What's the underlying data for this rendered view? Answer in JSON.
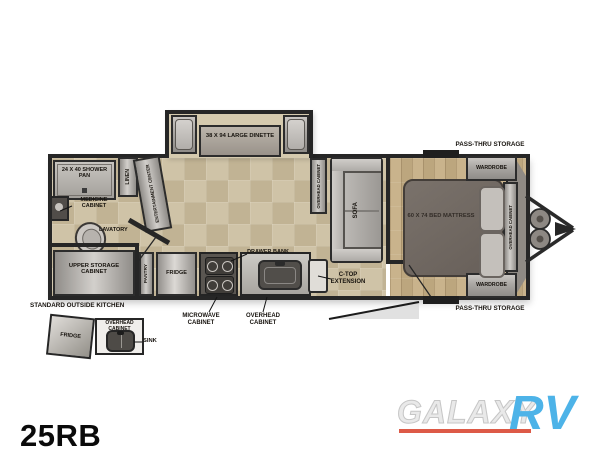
{
  "model": "25RB",
  "watermark": {
    "name": "GALAXY",
    "suffix": "RV"
  },
  "colors": {
    "wall": "#262626",
    "floor_main": "#cbbfa2",
    "floor_bedroom": "#c3ad86",
    "brand_blue": "#4db3e8",
    "brand_red": "#dd5a47"
  },
  "labels": {
    "shower": "24 x 40 SHOWER PAN",
    "linen": "LINEN",
    "medicine_cabinet": "MEDICINE CABINET",
    "lavatory": "LAVATORY",
    "entertainment_center": "ENTERTAINMENT CENTER",
    "upper_storage": "UPPER STORAGE CABINET",
    "pantry": "PANTRY",
    "fridge": "FRIDGE",
    "microwave_cabinet": "MICROWAVE CABINET",
    "overhead_cabinet": "OVERHEAD CABINET",
    "drawer_bank": "DRAWER BANK",
    "ctop_extension": "C-TOP EXTENSION",
    "dinette": "38 x 94 LARGE DINETTE",
    "sofa": "SOFA",
    "bed": "60 x 74 BED MATTRESS",
    "wardrobe": "WARDROBE",
    "passthru": "PASS-THRU STORAGE",
    "outside_kitchen": "STANDARD OUTSIDE KITCHEN",
    "outside_sink": "SINK"
  }
}
